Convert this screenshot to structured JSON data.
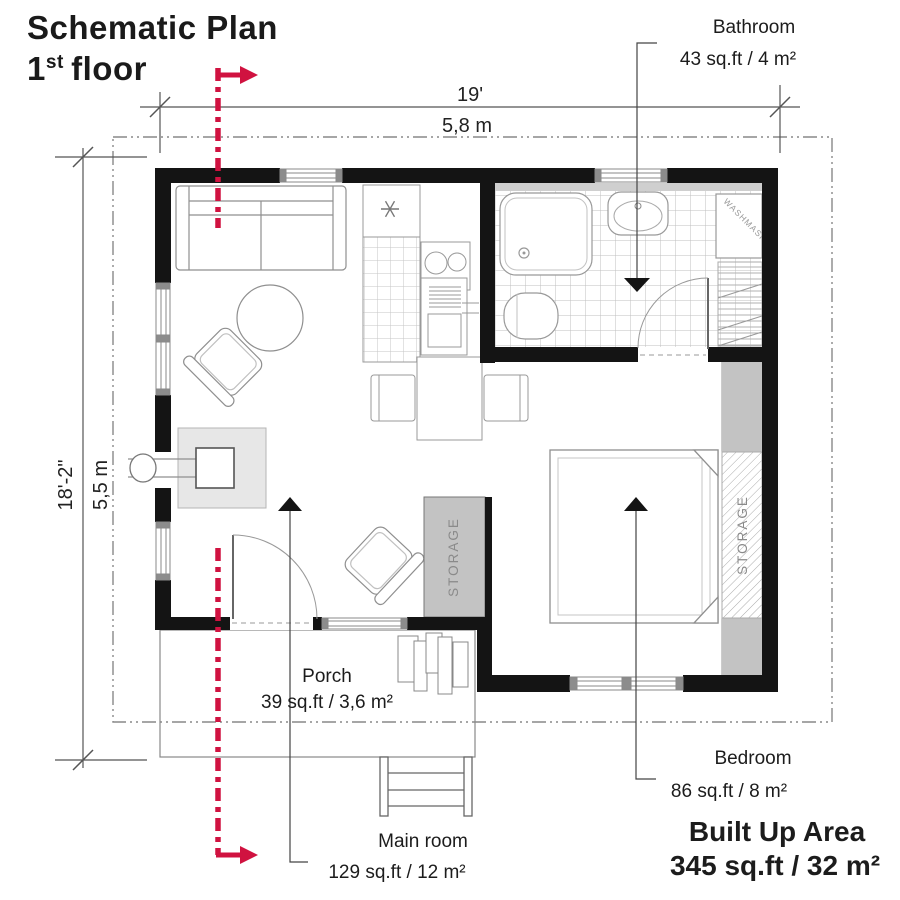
{
  "title": {
    "line1": "Schematic Plan",
    "floor_number": "1",
    "floor_ordinal": "st",
    "floor_word": "floor"
  },
  "dimensions": {
    "top_feet": "19'",
    "top_meters": "5,8 m",
    "left_feet": "18'-2\"",
    "left_meters": "5,5 m"
  },
  "labels": {
    "bathroom": {
      "name": "Bathroom",
      "area": "43 sq.ft / 4 m²"
    },
    "porch": {
      "name": "Porch",
      "area": "39 sq.ft / 3,6 m²"
    },
    "main_room": {
      "name": "Main room",
      "area": "129 sq.ft / 12 m²"
    },
    "bedroom": {
      "name": "Bedroom",
      "area": "86 sq.ft / 8 m²"
    },
    "built_up": {
      "name": "Built Up Area",
      "area": "345 sq.ft / 32 m²"
    }
  },
  "annotations": {
    "storage_right": "STORAGE",
    "storage_middle": "STORAGE",
    "washing_machine": "WASHMASINE"
  },
  "colors": {
    "section_line": "#d01240",
    "wall": "#141414",
    "storage_fill": "#c3c3c3",
    "fireplace_pad": "#e7e7e7",
    "dashed_outline": "#888888"
  }
}
